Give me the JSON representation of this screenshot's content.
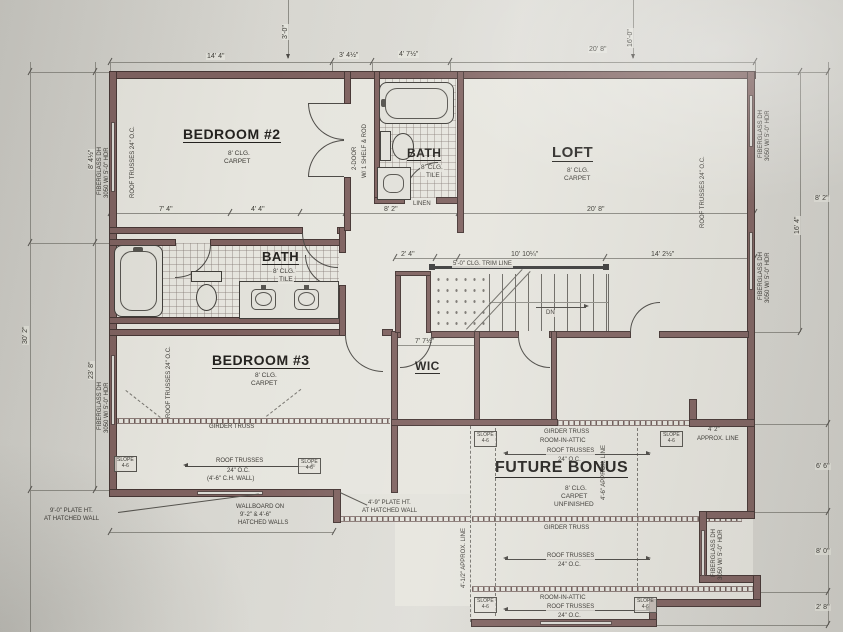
{
  "colors": {
    "paper": "#d7d6d0",
    "plan_fill": "#e6e5de",
    "wall": "#7e615f",
    "wall_edge": "#443432",
    "pencil": "#3a3833",
    "dim_line": "#8e8d86"
  },
  "rooms": {
    "bedroom2": {
      "name": "BEDROOM #2",
      "ceiling": "8' CLG.",
      "floor": "CARPET"
    },
    "bath_top": {
      "name": "BATH",
      "ceiling": "8' CLG.",
      "floor": "TILE"
    },
    "loft": {
      "name": "LOFT",
      "ceiling": "8' CLG.",
      "floor": "CARPET"
    },
    "bath_mid": {
      "name": "BATH",
      "ceiling": "8' CLG.",
      "floor": "TILE"
    },
    "bedroom3": {
      "name": "BEDROOM #3",
      "ceiling": "8' CLG.",
      "floor": "CARPET"
    },
    "wic": {
      "name": "WIC"
    },
    "bonus": {
      "name": "FUTURE BONUS",
      "ceiling": "8' CLG.",
      "floor": "CARPET",
      "status": "UNFINISHED"
    }
  },
  "dims": {
    "top": [
      "14' 4\"",
      "3' 4½\"",
      "4' 7½\"",
      "20' 8\""
    ],
    "upper": [
      "7' 4\"",
      "4' 4\"",
      "8' 2\"",
      "20' 8\""
    ],
    "mid": [
      "2' 4\"",
      "10' 10¼\"",
      "14' 2½\""
    ],
    "wic_width": "7' 7½\"",
    "left_upper": "8' 4½\"",
    "left_lower": "23' 8\"",
    "left_outer": "30' 2\"",
    "right_loft": "16' 4\"",
    "right_upper": "8' 2\"",
    "right_bay": [
      "6' 6\"",
      "8' 0\"",
      "2' 8\""
    ],
    "top_cut": [
      "3'-0\"",
      "16'-0\""
    ],
    "bonus_corner": "4' 2\""
  },
  "annotations": {
    "roof_trusses": "ROOF TRUSSES",
    "oc": "24\" O.C.",
    "roof_trusses_oc": "ROOF TRUSSES 24\" O.C.",
    "girder_truss": "GIRDER TRUSS",
    "room_in_attic": "ROOM-IN-ATTIC",
    "ch_wall": "(4'-6\" C.H. WALL)",
    "plate9_l1": "9'-0\" PLATE HT.",
    "plate9_l2": "AT HATCHED WALL",
    "plate4_l1": "4'-9\" PLATE HT.",
    "plate4_l2": "AT HATCHED WALL",
    "wallboard_l1": "WALLBOARD ON",
    "wallboard_l2": "9'-2\" & 4'-6\"",
    "wallboard_l3": "HATCHED WALLS",
    "window_dh": "FIBERGLASS DH",
    "window_size": "3050 W/ 5'-0\" HDR",
    "closet_door": "2-DOOR",
    "closet_shelf": "W/ 1 SHELF & ROD",
    "linen": "LINEN",
    "trim_line": "5'-0\" CLG. TRIM LINE",
    "dn": "DN",
    "slope": "SLOPE",
    "slope_val": "4-6",
    "approx_line": "APPROX. LINE",
    "approx_46": "4'-6\" APPROX. LINE",
    "approx_412": "4'-1/2\" APPROX. LINE"
  }
}
